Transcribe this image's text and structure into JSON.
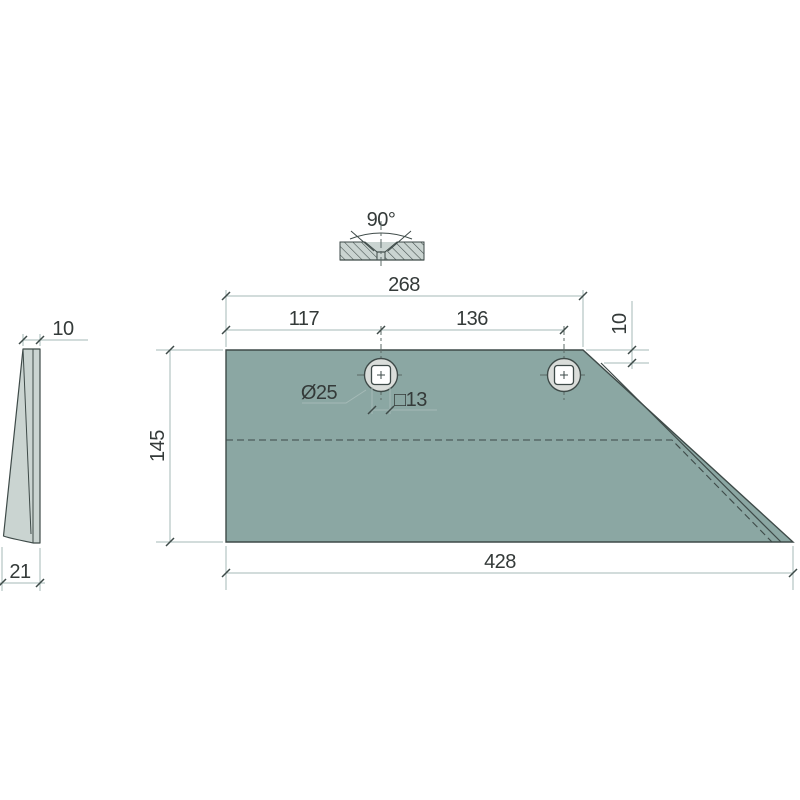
{
  "drawing_type": "technical-drawing-plough-share-wing-blade",
  "colors": {
    "blade-fill": "#8BA7A3",
    "light-fill": "#CAD4D1",
    "ring-fill": "#DADDDA",
    "line-dark": "#3E4A48",
    "dim-line": "#A5BAB7",
    "center-line": "#5B6866",
    "text-color": "#343A39",
    "background": "#FFFFFF"
  },
  "views": {
    "side_view": {
      "thickness_top": "10",
      "thickness_bottom": "21"
    },
    "countersink_detail": {
      "angle": "90°"
    },
    "main_view": {
      "overall_top": "268",
      "hole1_offset": "117",
      "hole_spacing": "136",
      "bevel_offset": "10",
      "height": "145",
      "base_length": "428",
      "hole_diameter": "Ø25",
      "square_hole": "□13"
    }
  }
}
